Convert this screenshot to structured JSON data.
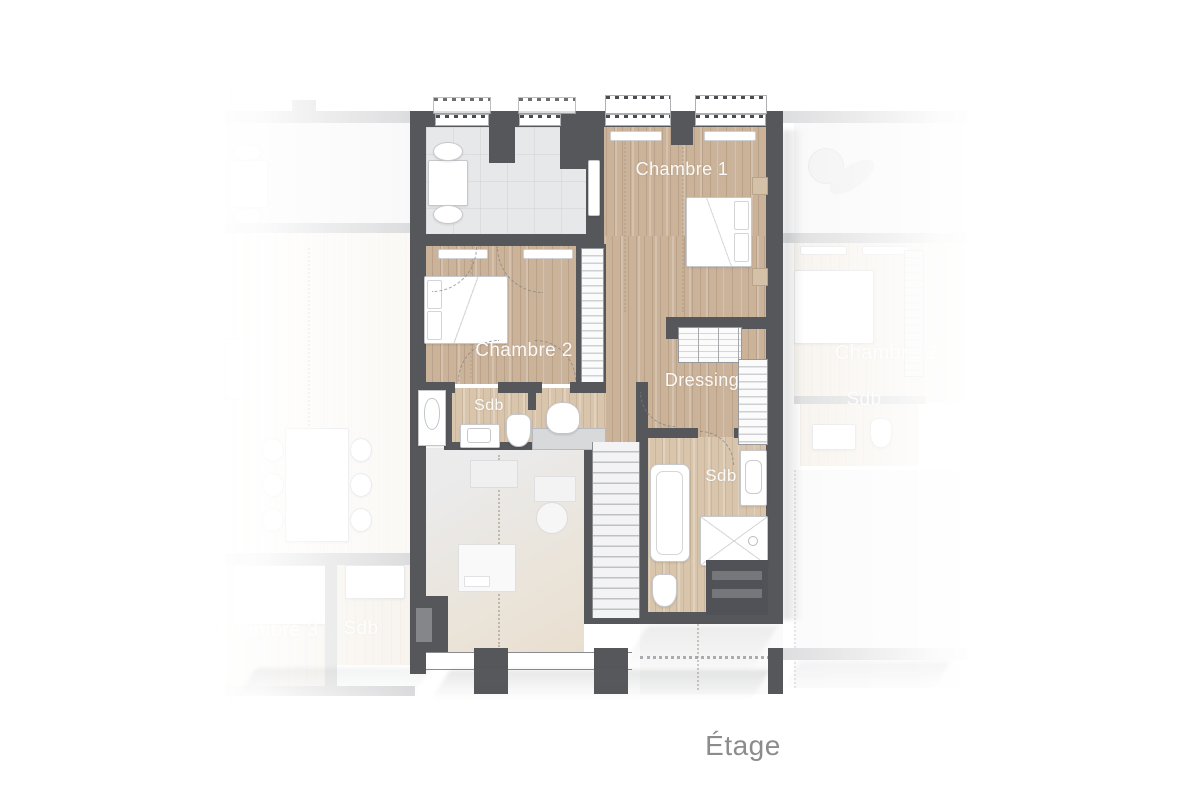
{
  "caption": {
    "text": "Étage"
  },
  "colors": {
    "wall": "#56575b",
    "wood": "#cbb39a",
    "wood-light": "#d8c5ac",
    "gray-floor": "#e7e8ea",
    "faded-floor": "#f2ede6",
    "furniture": "#ffffff",
    "label-text": "#ffffff",
    "caption": "#8c8c8e",
    "background": "#ffffff"
  },
  "units": {
    "central": {
      "name": "main-apartment",
      "rooms": [
        {
          "id": "chambre-1",
          "label": "Chambre 1",
          "furniture": [
            "double-bed",
            "nightstand",
            "nightstand",
            "radiator"
          ]
        },
        {
          "id": "chambre-2",
          "label": "Chambre 2",
          "furniture": [
            "double-bed",
            "wardrobe"
          ]
        },
        {
          "id": "dressing",
          "label": "Dressing",
          "furniture": [
            "wardrobe-top",
            "wardrobe-right"
          ]
        },
        {
          "id": "sdb-small",
          "label": "Sdb",
          "furniture": [
            "washbasin",
            "toilet"
          ]
        },
        {
          "id": "sdb-large",
          "label": "Sdb",
          "furniture": [
            "bathtub",
            "washbasin",
            "shower",
            "toilet"
          ]
        }
      ],
      "circulation": [
        "staircase",
        "hallway",
        "study-area",
        "terrace"
      ]
    },
    "left": {
      "name": "neighbour-unit-left",
      "rooms": [
        {
          "id": "chambre-3",
          "label": "Chambre 3",
          "furniture": [
            "double-bed"
          ]
        },
        {
          "id": "sdb",
          "label": "Sdb",
          "furniture": [
            "washbasin"
          ]
        }
      ]
    },
    "right": {
      "name": "neighbour-unit-right",
      "rooms": [
        {
          "id": "chambre-2",
          "label": "Chambre 2",
          "furniture": [
            "double-bed"
          ]
        },
        {
          "id": "sdb",
          "label": "Sdb",
          "furniture": [
            "washbasin",
            "toilet"
          ]
        }
      ]
    }
  }
}
